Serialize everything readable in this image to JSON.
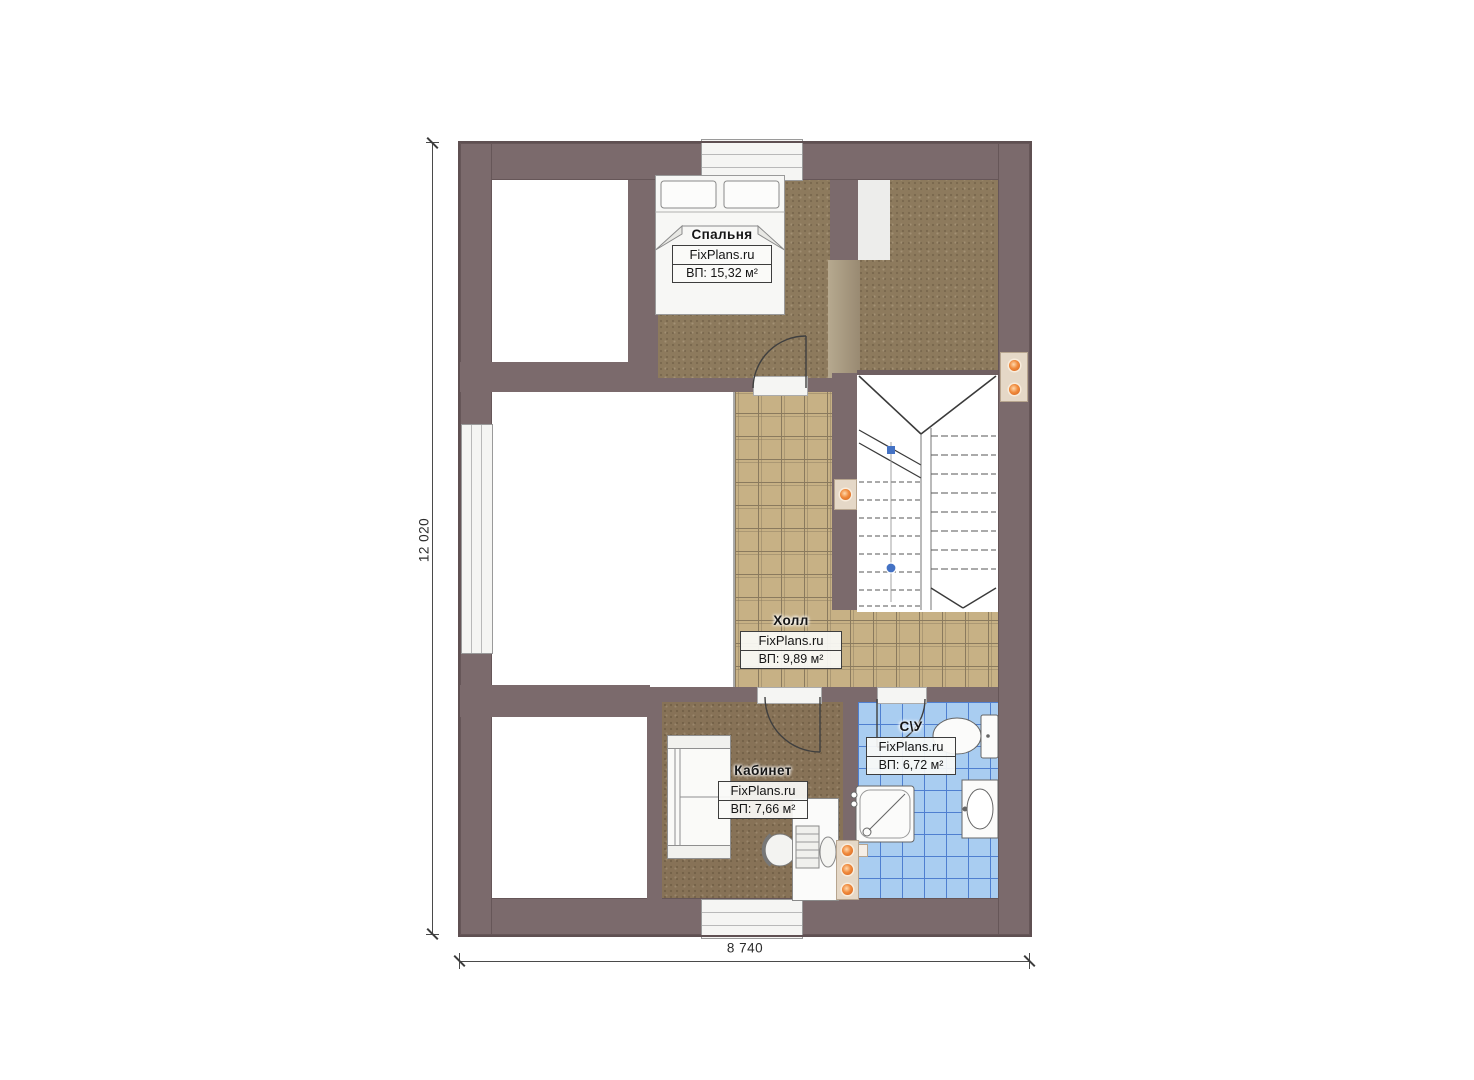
{
  "plan": {
    "watermark": "FixPlans.ru",
    "rooms": {
      "bedroom": {
        "name": "Спальня",
        "area": "ВП: 15,32 м²"
      },
      "hall": {
        "name": "Холл",
        "area": "ВП: 9,89 м²"
      },
      "office": {
        "name": "Кабинет",
        "area": "ВП: 7,66 м²"
      },
      "bathroom": {
        "name": "С\\У",
        "area": "ВП: 6,72 м²"
      }
    },
    "dimensions": {
      "vertical": "12 020",
      "horizontal": "8 740"
    },
    "colors": {
      "wall": "#7b6a6c",
      "carpet": "#8d7a5d",
      "office_carpet": "#877257",
      "hall_tile": "#c7b185",
      "bath_tile": "#a9cdf1",
      "accent_orange": "#e8742c",
      "marker_blue": "#4472c4"
    }
  }
}
